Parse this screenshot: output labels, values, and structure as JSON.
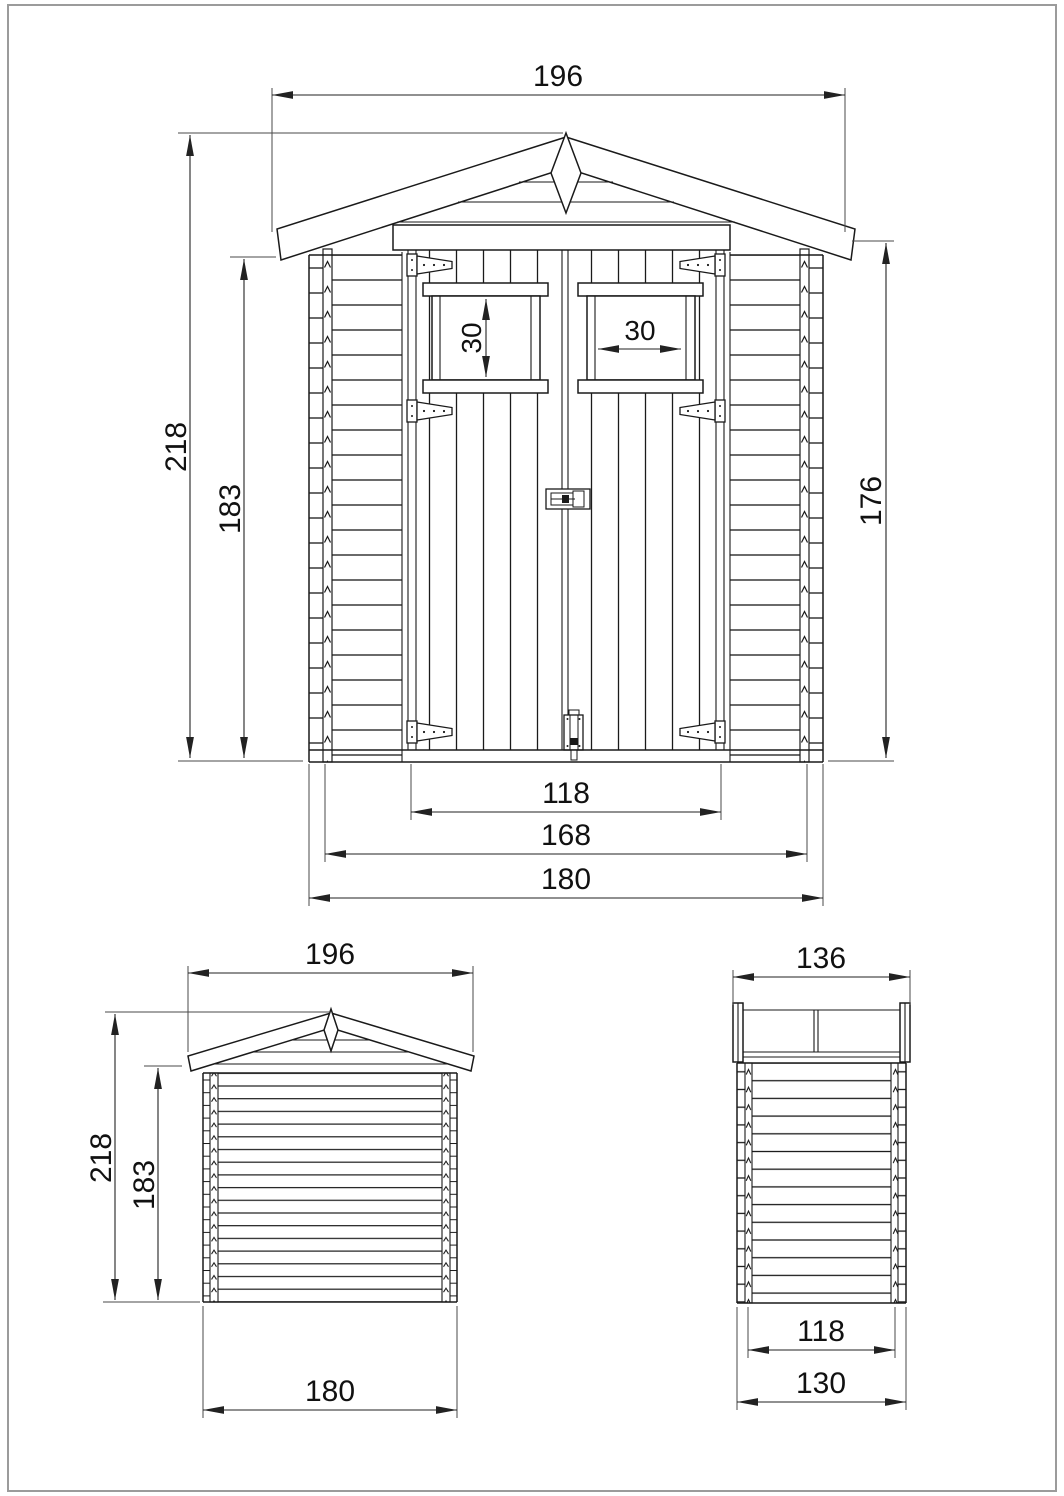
{
  "colors": {
    "background": "#ffffff",
    "line": "#1a1a1a",
    "dimension": "#222222",
    "extension": "#4a4a4a",
    "frame_border": "#9b9b9b"
  },
  "views": {
    "front": {
      "dims": {
        "roof_width": "196",
        "overall_height": "218",
        "wall_height": "183",
        "eave_height": "176",
        "window_height": "30",
        "window_width": "30",
        "door_opening_width": "118",
        "wall_outer_width": "168",
        "base_width": "180"
      }
    },
    "back": {
      "dims": {
        "roof_width": "196",
        "overall_height": "218",
        "wall_height": "183",
        "base_width": "180"
      }
    },
    "side": {
      "dims": {
        "roof_depth": "136",
        "inner_depth": "118",
        "base_depth": "130"
      }
    }
  }
}
